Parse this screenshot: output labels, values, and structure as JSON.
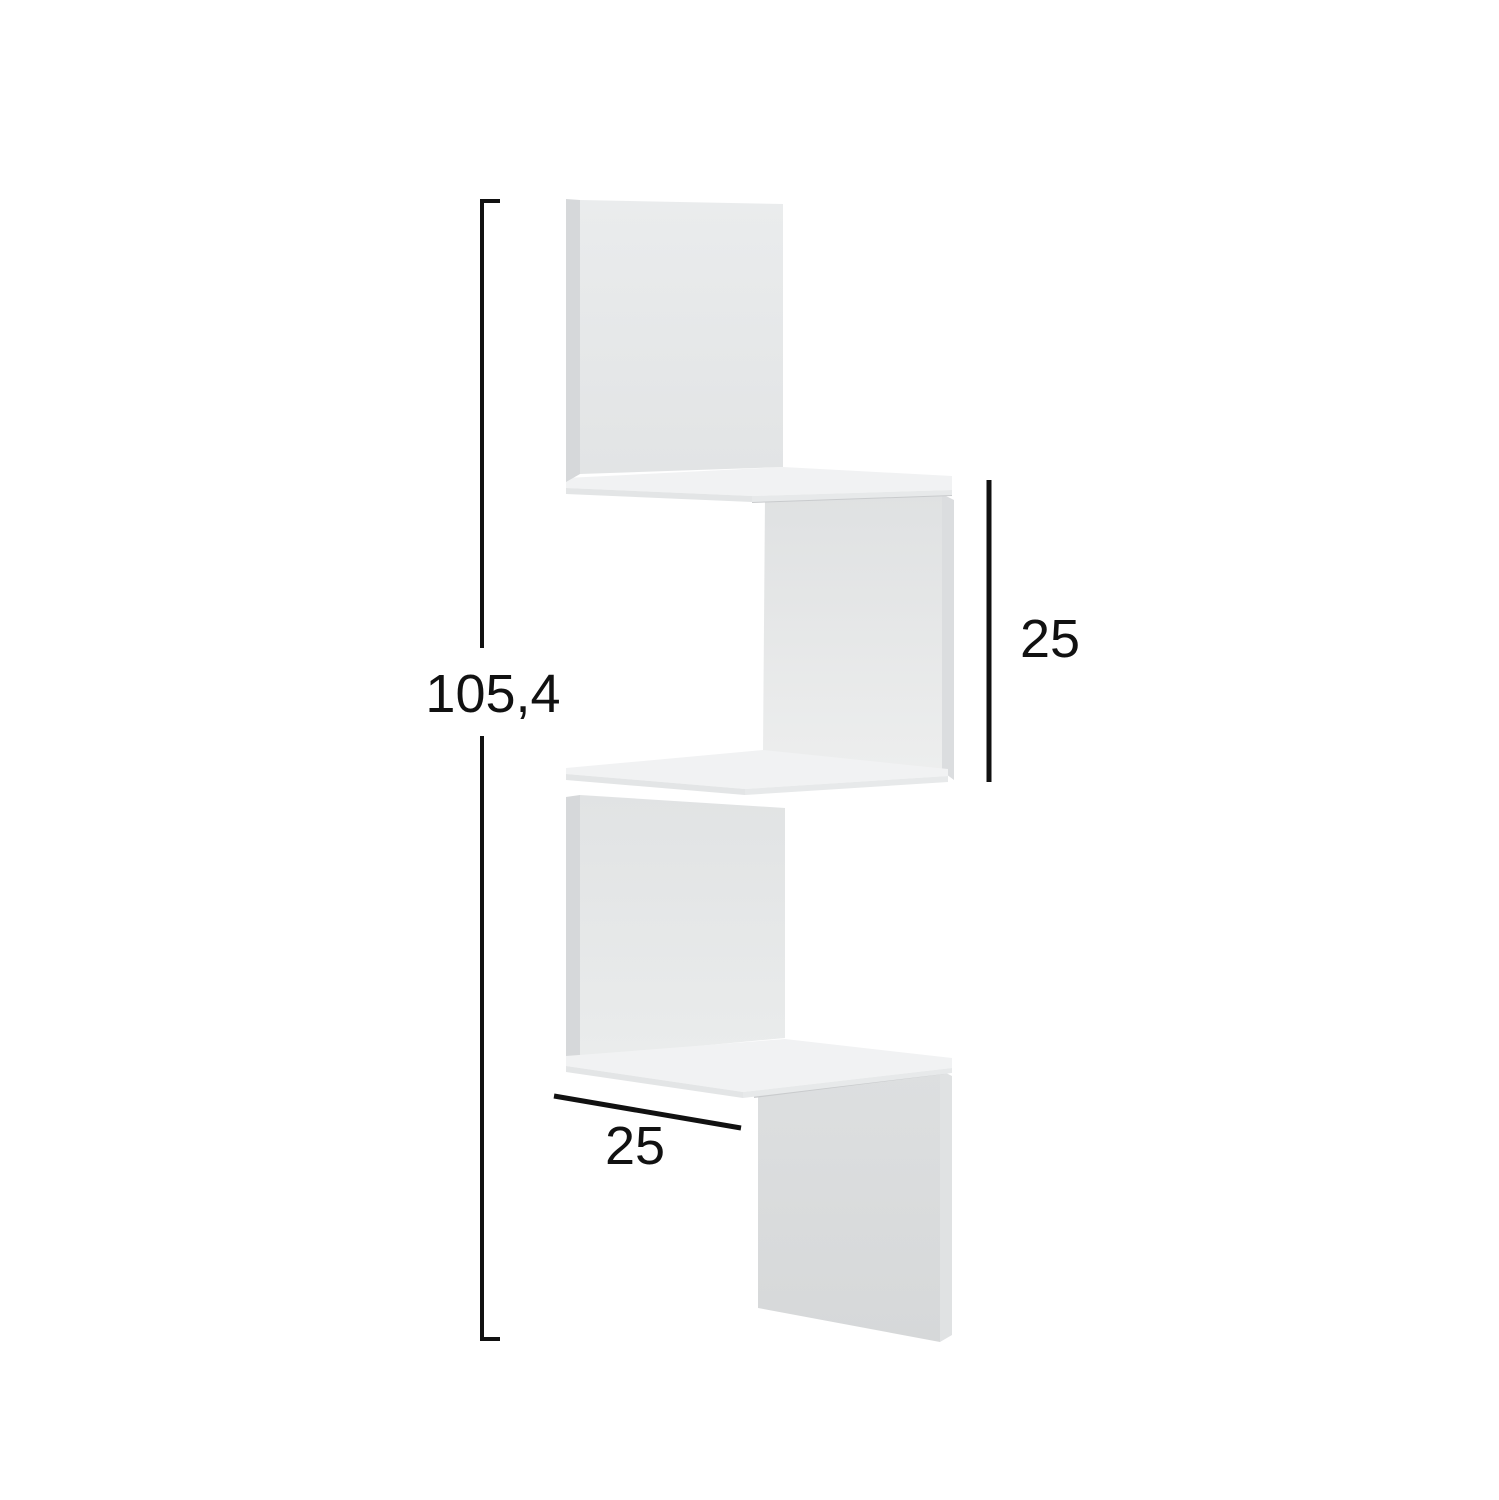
{
  "canvas": {
    "width": 1499,
    "height": 1500,
    "background": "#ffffff"
  },
  "diagram": {
    "subject": "3-tier zigzag corner wall shelf, 3D product render with dimensions",
    "labels": {
      "height": "105,4",
      "inner_height": "25",
      "depth": "25"
    },
    "colors": {
      "dimension": "#111111",
      "shelf_top": "#f1f2f3",
      "shelf_edge": "#e3e5e6",
      "shelf_edge_light": "#e7e9ea",
      "strip_left": "#d6d8da",
      "strip_right_mid": "#dbdddf",
      "strip_right_bottom": "#e0e2e3",
      "seam": "#c9cbcd",
      "panel_top_face_top": "#eaeced",
      "panel_top_face_bottom": "#e2e4e5",
      "panel_mid_face_top": "#dfe1e2",
      "panel_mid_face_bottom": "#edeeee",
      "panel_third_face_top": "#e1e3e4",
      "panel_third_face_bottom": "#eaecec",
      "panel_bottom_face_top": "#dddfe0",
      "panel_bottom_face_bottom": "#d6d8d9"
    }
  }
}
